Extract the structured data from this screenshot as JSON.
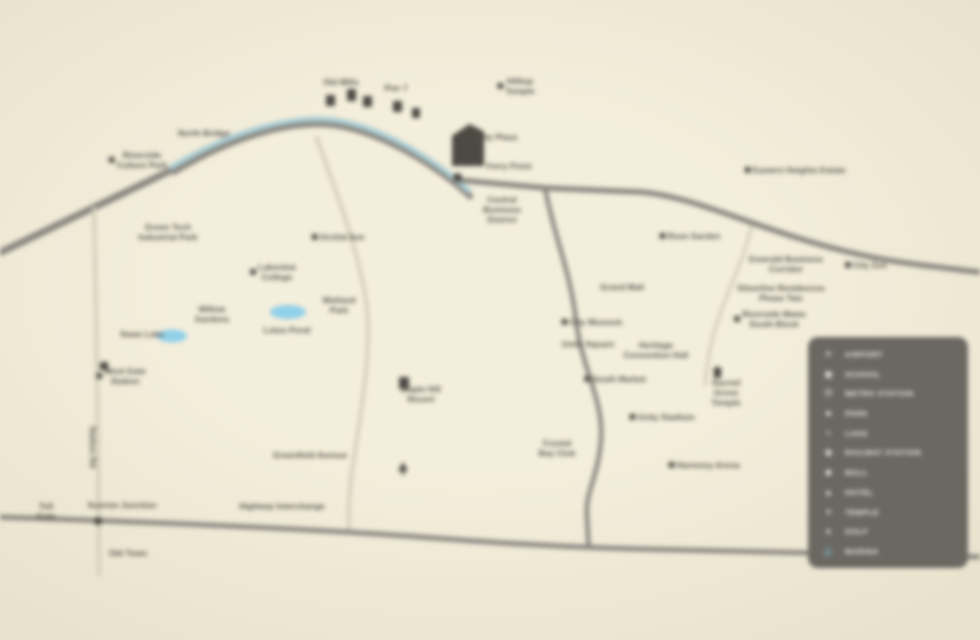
{
  "colors": {
    "bg": "#f4eedc",
    "bg-edge": "#e8e1cc",
    "road": "#8a8780",
    "light-road": "#d1cbb8",
    "river": "#a9cdd4",
    "lake": "#90d0ea",
    "label": "#55524b",
    "icon": "#4d4a44",
    "legend-bg": "#6b6862",
    "legend-text": "#f2efe8"
  },
  "map": {
    "labels": [
      {
        "text": "North Bridge",
        "x": 204,
        "y": 133
      },
      {
        "text": "Riverside\nCulture Park",
        "x": 138,
        "y": 160,
        "marker": true
      },
      {
        "text": "Old Mills",
        "x": 341,
        "y": 82
      },
      {
        "text": "Pier 7",
        "x": 396,
        "y": 88
      },
      {
        "text": "Hilltop\nTemple",
        "x": 516,
        "y": 86,
        "marker": true
      },
      {
        "text": "City Plaza",
        "x": 497,
        "y": 137
      },
      {
        "text": "Ferry Point",
        "x": 509,
        "y": 166
      },
      {
        "text": "Central\nBusiness\nDistrict",
        "x": 502,
        "y": 210
      },
      {
        "text": "Green Tech\nIndustrial Park",
        "x": 168,
        "y": 232
      },
      {
        "text": "Orchid Ave",
        "x": 338,
        "y": 237,
        "marker": true
      },
      {
        "text": "Lakeview\nCollege",
        "x": 273,
        "y": 272,
        "marker": true
      },
      {
        "text": "Wetland\nPark",
        "x": 339,
        "y": 305
      },
      {
        "text": "Willow\nGardens",
        "x": 212,
        "y": 314
      },
      {
        "text": "Swan Lake",
        "x": 142,
        "y": 334
      },
      {
        "text": "Lotus Pond",
        "x": 287,
        "y": 330
      },
      {
        "text": "West Gate\nStation",
        "x": 121,
        "y": 376,
        "marker": true
      },
      {
        "text": "Maple Hill\nResort",
        "x": 421,
        "y": 394
      },
      {
        "text": "Greenfield Avenue",
        "x": 310,
        "y": 455
      },
      {
        "text": "Station Rd",
        "x": 93,
        "y": 447,
        "vertical": true
      },
      {
        "text": "Toll\nGate",
        "x": 46,
        "y": 511
      },
      {
        "text": "Sunrise Junction",
        "x": 122,
        "y": 505
      },
      {
        "text": "Old Town",
        "x": 128,
        "y": 553
      },
      {
        "text": "Highway Interchange",
        "x": 282,
        "y": 506
      },
      {
        "text": "Rose Garden",
        "x": 690,
        "y": 236,
        "marker": true
      },
      {
        "text": "Grand Mall",
        "x": 622,
        "y": 287
      },
      {
        "text": "City Museum",
        "x": 592,
        "y": 322,
        "marker": true
      },
      {
        "text": "Unity Square",
        "x": 588,
        "y": 344
      },
      {
        "text": "Heritage\nConvention Hall",
        "x": 656,
        "y": 350
      },
      {
        "text": "South Market",
        "x": 615,
        "y": 379,
        "marker": true
      },
      {
        "text": "Sacred\nGrove\nTemple",
        "x": 726,
        "y": 393
      },
      {
        "text": "Unity Stadium",
        "x": 662,
        "y": 417,
        "marker": true
      },
      {
        "text": "Crystal\nBay Club",
        "x": 557,
        "y": 448
      },
      {
        "text": "Harmony Arena",
        "x": 704,
        "y": 465,
        "marker": true
      },
      {
        "text": "Eastern Heights Estate",
        "x": 795,
        "y": 170,
        "marker": true
      },
      {
        "text": "Emerald Business\nCorridor",
        "x": 786,
        "y": 264
      },
      {
        "text": "City Zoo",
        "x": 866,
        "y": 265,
        "marker": true
      },
      {
        "text": "Silverline Residences\nPhase Two",
        "x": 781,
        "y": 293
      },
      {
        "text": "Riverside Mews\nSouth Block",
        "x": 770,
        "y": 319,
        "marker": true
      }
    ],
    "icons": [
      {
        "type": "building",
        "x": 452,
        "y": 124,
        "w": 32,
        "h": 42
      },
      {
        "type": "dot",
        "x": 453,
        "y": 173,
        "w": 9,
        "h": 9
      },
      {
        "type": "block",
        "x": 326,
        "y": 95,
        "w": 9,
        "h": 11
      },
      {
        "type": "block",
        "x": 347,
        "y": 89,
        "w": 9,
        "h": 12
      },
      {
        "type": "block",
        "x": 363,
        "y": 96,
        "w": 9,
        "h": 11
      },
      {
        "type": "block",
        "x": 393,
        "y": 101,
        "w": 9,
        "h": 11
      },
      {
        "type": "block",
        "x": 412,
        "y": 108,
        "w": 8,
        "h": 10
      },
      {
        "type": "block",
        "x": 399,
        "y": 377,
        "w": 10,
        "h": 12
      },
      {
        "type": "tree",
        "x": 398,
        "y": 462,
        "w": 10,
        "h": 13
      },
      {
        "type": "temple",
        "x": 712,
        "y": 366,
        "w": 11,
        "h": 12
      },
      {
        "type": "dot",
        "x": 94,
        "y": 517,
        "w": 8,
        "h": 8
      },
      {
        "type": "block",
        "x": 100,
        "y": 362,
        "w": 8,
        "h": 8
      }
    ]
  },
  "legend": {
    "items": [
      {
        "glyph": "✈",
        "label": "AIRPORT"
      },
      {
        "glyph": "▣",
        "label": "SCHOOL"
      },
      {
        "glyph": "Ⓜ",
        "label": "METRO STATION"
      },
      {
        "glyph": "♣",
        "label": "PARK"
      },
      {
        "glyph": "≈",
        "label": "LAKE"
      },
      {
        "glyph": "◉",
        "label": "RAILWAY STATION"
      },
      {
        "glyph": "◆",
        "label": "MALL"
      },
      {
        "glyph": "▲",
        "label": "HOTEL"
      },
      {
        "glyph": "✦",
        "label": "TEMPLE"
      },
      {
        "glyph": "●",
        "label": "GOLF"
      },
      {
        "glyph": "⚓",
        "label": "MARINA"
      }
    ]
  }
}
